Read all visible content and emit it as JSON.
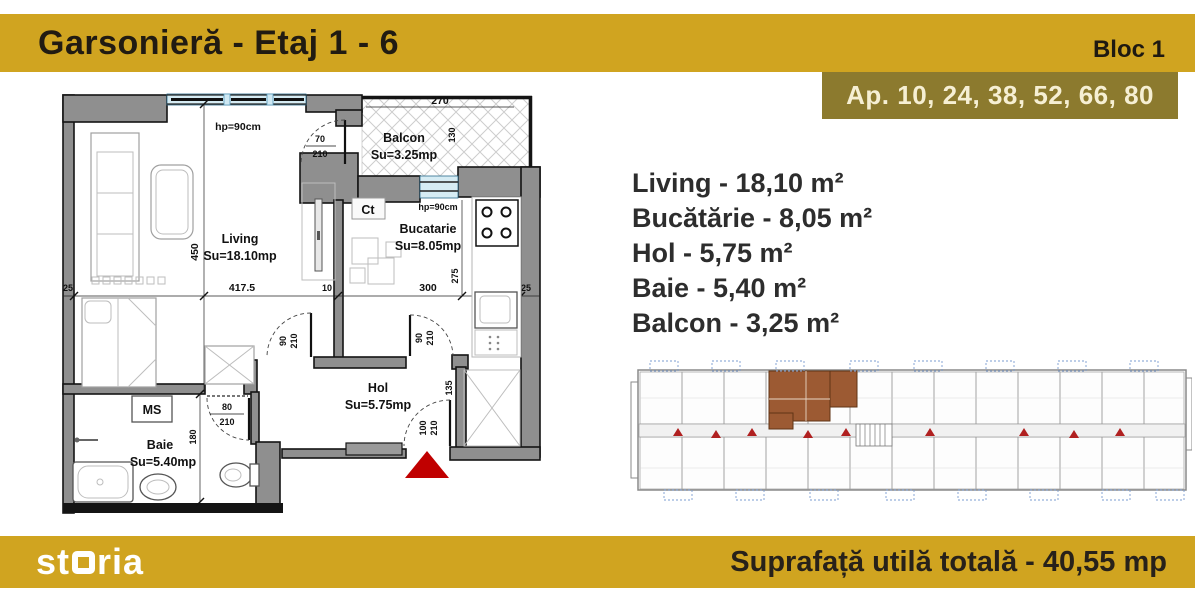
{
  "header": {
    "title": "Garsonieră - Etaj 1 - 6",
    "bloc_label": "Bloc 1",
    "apartments_label": "Ap. 10, 24, 38, 52, 66, 80"
  },
  "colors": {
    "gold": "#D0A420",
    "olive_badge": "#8C7A2E",
    "badge_text": "#F6EFD3",
    "accent_red": "#C00000",
    "highlight_brown": "#9C5A33"
  },
  "room_list": [
    "Living - 18,10 m²",
    "Bucătărie - 8,05 m²",
    "Hol - 5,75 m²",
    "Baie - 5,40 m²",
    "Balcon - 3,25 m²"
  ],
  "floor_plan": {
    "living": {
      "name": "Living",
      "area": "Su=18.10mp"
    },
    "balcon": {
      "name": "Balcon",
      "area": "Su=3.25mp"
    },
    "bucatarie": {
      "name": "Bucatarie",
      "area": "Su=8.05mp"
    },
    "hol": {
      "name": "Hol",
      "area": "Su=5.75mp"
    },
    "baie": {
      "name": "Baie",
      "area": "Su=5.40mp"
    },
    "labels": {
      "ct": "Ct",
      "ms": "MS",
      "window_top": "hp=90cm",
      "window_kitchen": "hp=90cm"
    },
    "dims": {
      "left": "25",
      "living_width": "417.5",
      "wall": "10",
      "kitchen_width": "300",
      "right": "25",
      "living_height": "450",
      "baie_height": "180",
      "kitchen_height": "275",
      "balcon_width": "270",
      "balcon_height": "130",
      "hall": "135",
      "door_balcon_w": "70",
      "door_balcon_h": "210",
      "door_bed_w": "90",
      "door_bed_h": "210",
      "door_kitchen_w": "90",
      "door_kitchen_h": "210",
      "door_baie_w": "80",
      "door_baie_h": "210",
      "door_entry_w": "100",
      "door_entry_h": "210"
    }
  },
  "footer": {
    "logo_prefix": "st",
    "logo_suffix": "ria",
    "total_label": "Suprafață utilă totală - 40,55 mp"
  }
}
